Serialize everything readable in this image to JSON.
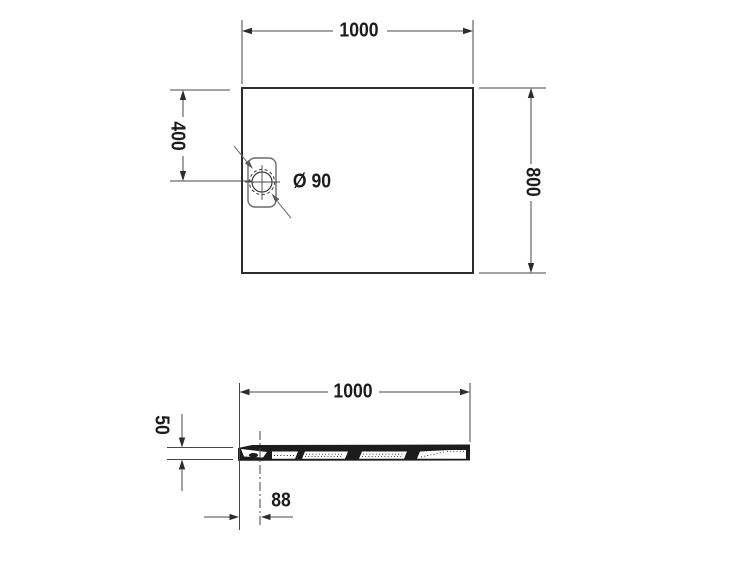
{
  "colors": {
    "background": "#ffffff",
    "linework": "#474747",
    "outline": "#2d2d2d",
    "leader": "#6f6f6f",
    "text": "#1c1c1c"
  },
  "top_view": {
    "width_dim": "1000",
    "height_dim": "800",
    "drain_offset_dim": "400",
    "drain_diameter_dim": "Ø 90"
  },
  "side_view": {
    "width_dim": "1000",
    "thickness_dim": "50",
    "drain_offset_dim": "88"
  }
}
